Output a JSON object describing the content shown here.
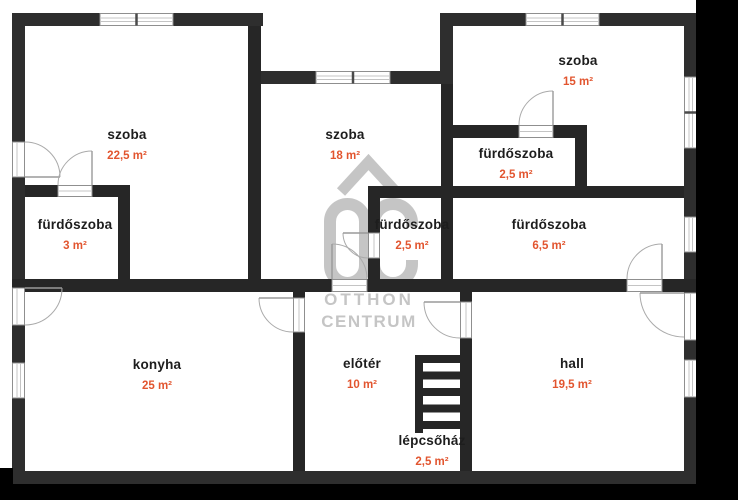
{
  "watermark": {
    "logo": "OC",
    "line1": "OTTHON",
    "line2": "CENTRUM",
    "color": "#b5b5b5"
  },
  "colors": {
    "outer_wall": "#2e2e2e",
    "inner_wall": "#262626",
    "room_name_text": "#1d1d1d",
    "area_text": "#e2552f",
    "background": "#ffffff",
    "outside": "#000000",
    "fixture_line": "#9a9a9a"
  },
  "rooms": [
    {
      "id": "szoba-22",
      "name": "szoba",
      "area": "22,5 m²"
    },
    {
      "id": "szoba-18",
      "name": "szoba",
      "area": "18 m²"
    },
    {
      "id": "szoba-15",
      "name": "szoba",
      "area": "15 m²"
    },
    {
      "id": "furdoszoba-3",
      "name": "fürdőszoba",
      "area": "3 m²"
    },
    {
      "id": "furdoszoba-25-center",
      "name": "fürdőszoba",
      "area": "2,5 m²"
    },
    {
      "id": "furdoszoba-25-top",
      "name": "fürdőszoba",
      "area": "2,5 m²"
    },
    {
      "id": "furdoszoba-65",
      "name": "fürdőszoba",
      "area": "6,5 m²"
    },
    {
      "id": "konyha",
      "name": "konyha",
      "area": "25 m²"
    },
    {
      "id": "eloter",
      "name": "előtér",
      "area": "10 m²"
    },
    {
      "id": "hall",
      "name": "hall",
      "area": "19,5 m²"
    },
    {
      "id": "lepcsohaz",
      "name": "lépcsőház",
      "area": "2,5 m²"
    }
  ]
}
